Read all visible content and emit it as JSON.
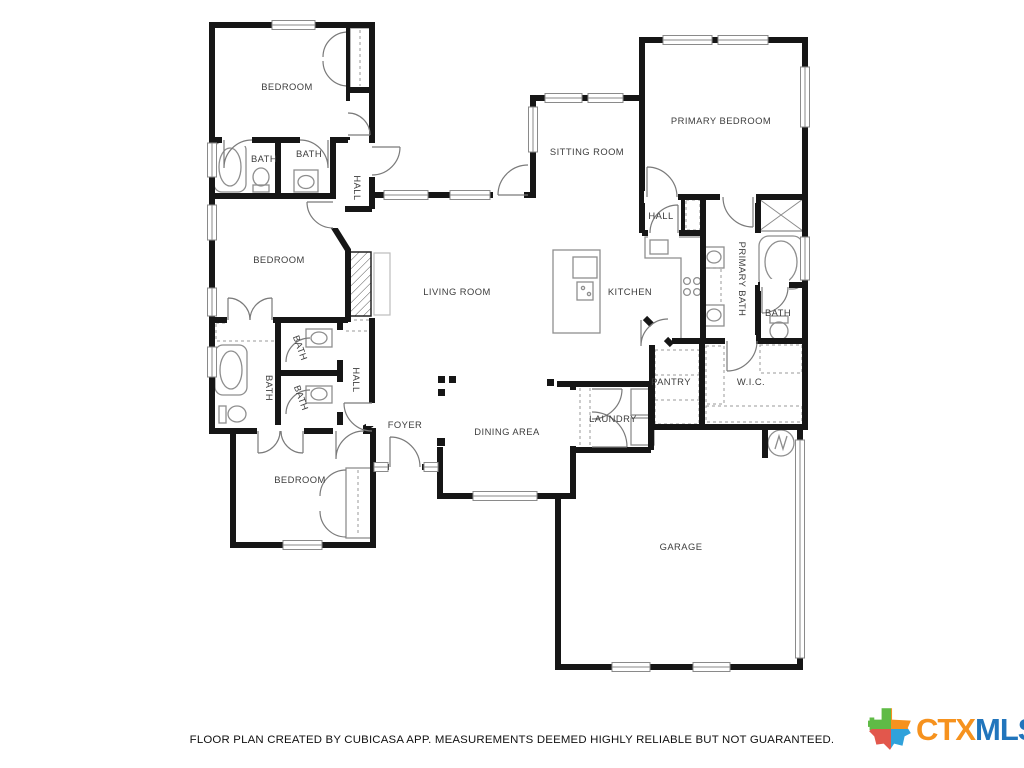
{
  "page": {
    "background": "#ffffff",
    "width": 1024,
    "height": 768
  },
  "rooms": [
    {
      "id": "bedroom-top",
      "label": "BEDROOM"
    },
    {
      "id": "bath-top-left",
      "label": "BATH"
    },
    {
      "id": "bath-top-mid",
      "label": "BATH"
    },
    {
      "id": "hall-top",
      "label": "HALL"
    },
    {
      "id": "sitting-room",
      "label": "SITTING ROOM"
    },
    {
      "id": "primary-bedroom",
      "label": "PRIMARY BEDROOM"
    },
    {
      "id": "hall-right",
      "label": "HALL"
    },
    {
      "id": "bedroom-mid",
      "label": "BEDROOM"
    },
    {
      "id": "living-room",
      "label": "LIVING ROOM"
    },
    {
      "id": "kitchen",
      "label": "KITCHEN"
    },
    {
      "id": "primary-bath",
      "label": "PRIMARY BATH"
    },
    {
      "id": "bath-right",
      "label": "BATH"
    },
    {
      "id": "bath-mid-left",
      "label": "BATH"
    },
    {
      "id": "bath-small-1",
      "label": "BATH"
    },
    {
      "id": "bath-small-2",
      "label": "BATH"
    },
    {
      "id": "hall-lower",
      "label": "HALL"
    },
    {
      "id": "pantry",
      "label": "PANTRY"
    },
    {
      "id": "wic",
      "label": "W.I.C."
    },
    {
      "id": "laundry",
      "label": "LAUNDRY"
    },
    {
      "id": "foyer",
      "label": "FOYER"
    },
    {
      "id": "dining-area",
      "label": "DINING AREA"
    },
    {
      "id": "bedroom-bottom",
      "label": "BEDROOM"
    },
    {
      "id": "garage",
      "label": "GARAGE"
    }
  ],
  "footer": {
    "disclaimer": "FLOOR PLAN CREATED BY CUBICASA APP. MEASUREMENTS DEEMED HIGHLY RELIABLE BUT NOT GUARANTEED."
  },
  "logo": {
    "ctx": "CTX",
    "mls": "MLS",
    "colors": {
      "ctx_text": "#F6921E",
      "mls_text": "#2175BC",
      "texas_green": "#5FBB46",
      "texas_orange": "#F6921E",
      "texas_red": "#E2574C",
      "texas_blue": "#30A2DB"
    }
  }
}
